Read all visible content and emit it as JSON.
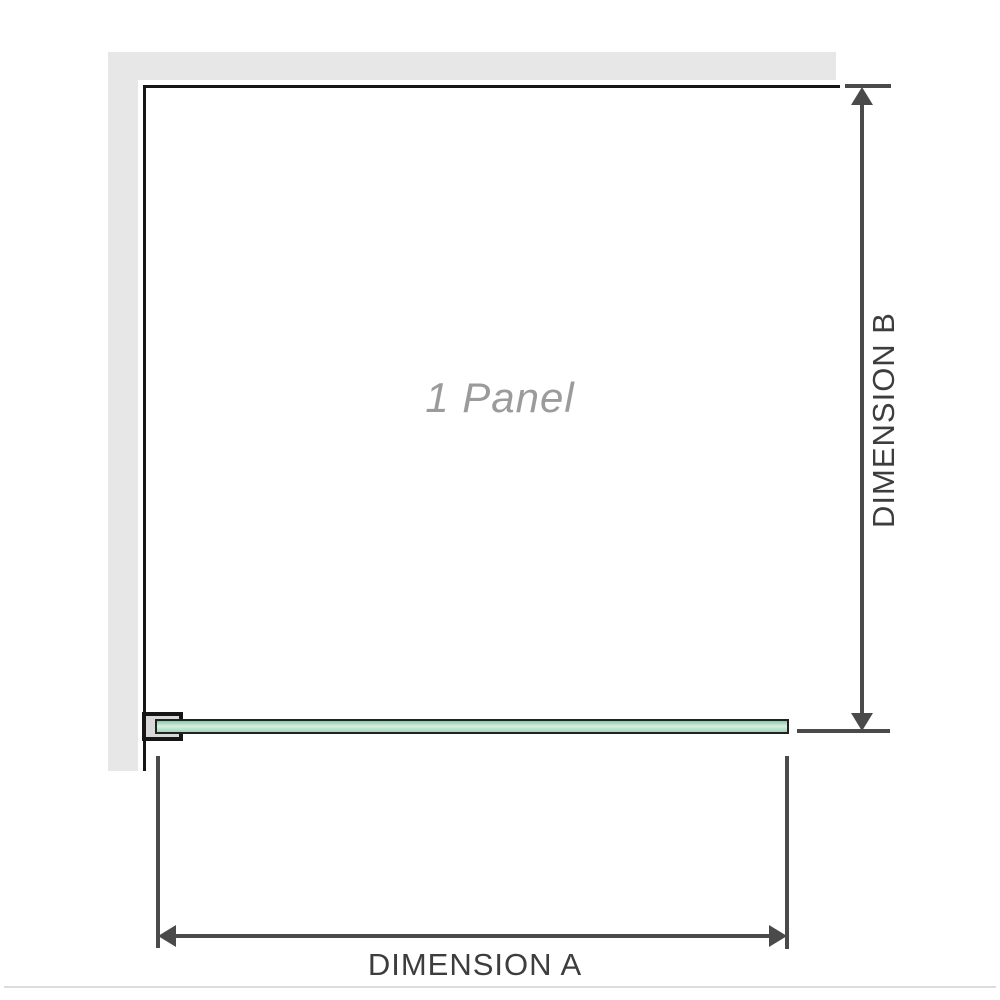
{
  "labels": {
    "panel": "1 Panel",
    "dimension_a": "DIMENSION A",
    "dimension_b": "DIMENSION B"
  },
  "colors": {
    "background": "#ffffff",
    "wall-gray": "#e7e7e7",
    "frame-black": "#161616",
    "dimension-gray": "#4a4a4a",
    "dimension-text": "#3d3d3d",
    "panel-label-gray": "#9b9b9b",
    "glass-green-edge": "#8cc9a5",
    "glass-green-light": "#d7efe2",
    "glass-green-bottom": "#a2d5b8",
    "glass-outline": "#222222",
    "bracket-fill": "#d8d8d8",
    "baseline-gray": "#dcdcdc"
  }
}
